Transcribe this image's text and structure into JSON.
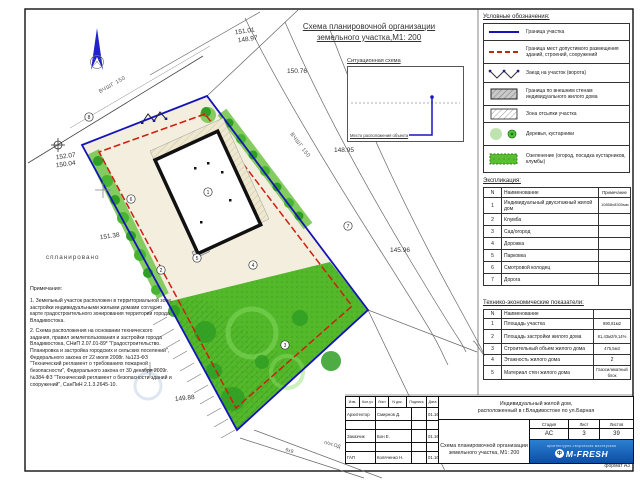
{
  "title": {
    "line1": "Схема планировочной организации",
    "line2": "земельного участка,М1: 200"
  },
  "situational": {
    "title": "Ситуационная схема",
    "label": "Место расположения объекта"
  },
  "legend": {
    "title": "Условные обозначения:",
    "items": [
      {
        "symbol": "boundary-line",
        "label": "Граница участка"
      },
      {
        "symbol": "red-dashed-line",
        "label": "Граница мест допустимого размещения зданий, строений, сооружений"
      },
      {
        "symbol": "gate-zigzag",
        "label": "Заезд на участок (ворота)"
      },
      {
        "symbol": "gray-hatch",
        "label": "Граница по внешним стенам индивидуального жилого дома"
      },
      {
        "symbol": "diag-hatch",
        "label": "Зона отсыпки участка"
      },
      {
        "symbol": "trees",
        "label": "Деревья, кустарники"
      },
      {
        "symbol": "green-fill",
        "label": "Озеленение (огород, посадка кустарников, клумбы)"
      }
    ]
  },
  "explication": {
    "title": "Экспликация:",
    "headers": {
      "n": "N",
      "name": "Наименование",
      "note": "Примечание"
    },
    "rows": [
      {
        "n": "1",
        "name": "Индивидуальный двухэтажный жилой дом",
        "note": "10858х8300мм"
      },
      {
        "n": "2",
        "name": "Клумба",
        "note": ""
      },
      {
        "n": "3",
        "name": "Сад/огород",
        "note": ""
      },
      {
        "n": "4",
        "name": "Дорожка",
        "note": ""
      },
      {
        "n": "5",
        "name": "Парковка",
        "note": ""
      },
      {
        "n": "6",
        "name": "Смотровой колодец",
        "note": ""
      },
      {
        "n": "7",
        "name": "Дорога",
        "note": ""
      }
    ]
  },
  "tep": {
    "title": "Технико-экономические показатели:",
    "headers": {
      "n": "N",
      "name": "Наименование",
      "value": ""
    },
    "rows": [
      {
        "n": "1",
        "name": "Площадь участка",
        "value": "890,81м2"
      },
      {
        "n": "2",
        "name": "Площадь застройки жилого дома",
        "value": "81,43м2/9,14%"
      },
      {
        "n": "3",
        "name": "Строительный объем жилого дома",
        "value": "475,5м3"
      },
      {
        "n": "4",
        "name": "Этажность жилого дома",
        "value": "2"
      },
      {
        "n": "5",
        "name": "Материал стен жилого дома",
        "value": "Газосиликатный блок"
      }
    ]
  },
  "notes": {
    "title": "Примечания:",
    "items": [
      "1. Земельный участок расположен в территориальной зоне застройки индивидуальными жилыми домами согласно карте градостроительного зонирования территории города Владивостока.",
      "2. Схема расположения на основании технического задания, правил землепользования и застройки города Владивостока, СНиП 2.07.01-89* \"Градостроительство. Планировка и застройка городских и сельских поселений\", Федерального закона от 22 июля 2008г. №123-ФЗ \"Технический регламент о требованиях пожарной безопасности\", Федерального закона от 30 декабря 2009г. №384-ФЗ \"Технический регламент о безопасности зданий и сооружений\", СанПиН 2.1.3.2645-10."
    ]
  },
  "plan": {
    "pipe_label": "ВЧШГ 150",
    "planned_label": "спланировано",
    "road_label_1": "6х9",
    "road_label_2": "п/эт.ОД",
    "elevations": [
      "151.01",
      "148.97",
      "150.76",
      "148.95",
      "145.96",
      "152.07",
      "150.04",
      "151.38",
      "149.88"
    ],
    "callouts": [
      "1",
      "2",
      "3",
      "4",
      "5",
      "6",
      "7",
      "8"
    ]
  },
  "stamp": {
    "header_cells": [
      "Изм.",
      "Кол.уч",
      "Лист",
      "N док.",
      "Подпись",
      "Дата"
    ],
    "rows": [
      {
        "role": "Архитектор",
        "name": "Смирнов Д.",
        "date": "01.16"
      },
      {
        "role": "Заказчик",
        "name": "Бон Е.",
        "date": "01.16"
      },
      {
        "role": "ГАП",
        "name": "Коляченко Н.",
        "date": "01.16"
      }
    ],
    "object_line1": "Индивидуальный жилой дом,",
    "object_line2": "расположенный в г.Владивостоке по ул.Барная",
    "sheet_title_line1": "Схема планировочной организации",
    "sheet_title_line2": "земельного участка, М1: 200",
    "stage_label": "Стадия",
    "sheet_label": "Лист",
    "sheets_label": "Листов",
    "stage": "АС",
    "sheet": "3",
    "sheets": "39",
    "logo_top": "архитектурно-творческая мастерская",
    "logo": "M-FRESH",
    "format": "формат А3"
  },
  "colors": {
    "boundary_blue": "#1414b8",
    "envelope_red": "#cf1f10",
    "garden_green": "#53b82a",
    "logo_blue": "#0a4fa8"
  }
}
